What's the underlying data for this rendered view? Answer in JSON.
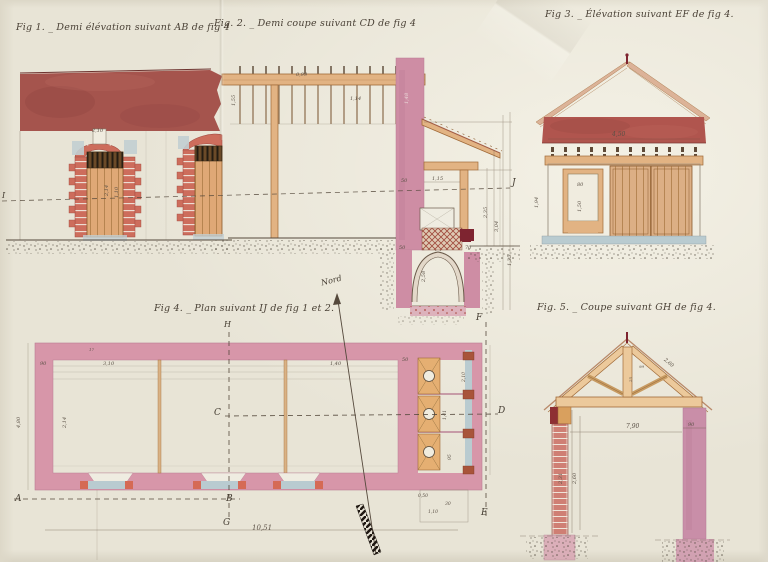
{
  "sheet": {
    "titles": {
      "fig1": "Fig 1. _ Demi élévation suivant AB de fig 4",
      "fig2": "Fig. 2. _ Demi coupe suivant CD de fig 4",
      "fig3": "Fig 3. _ Élévation suivant EF de fig 4.",
      "fig4": "Fig 4. _ Plan suivant IJ de fig 1 et 2.",
      "fig5": "Fig. 5. _ Coupe suivant GH de fig 4."
    },
    "north_label": "Nord",
    "letters": {
      "A": "A",
      "B": "B",
      "C": "C",
      "D": "D",
      "E": "E",
      "F": "F",
      "G": "G",
      "H": "H",
      "I": "I",
      "J": "J"
    },
    "dims": {
      "fig1": [
        "2,10",
        "2,14",
        "1,10"
      ],
      "fig2": [
        "0,99",
        "1,55",
        "1,14",
        "1,48",
        "50",
        "1,15",
        "2,35",
        "3,04",
        "1,35",
        "50",
        "70",
        "2,58"
      ],
      "fig3": [
        "4,50",
        "1,94",
        "80",
        "1,50"
      ],
      "fig4": [
        "3,10",
        "90",
        "1,40",
        "50",
        "4,80",
        "2,14",
        "2,10",
        "1,41",
        "95",
        "10,51",
        "0,50",
        "30",
        "1,10",
        "17"
      ],
      "fig5": [
        "7,90",
        "90",
        "2,31",
        "2,60",
        "2,60",
        "99",
        "25"
      ]
    },
    "colors": {
      "paper": "#e8e4d6",
      "roof_red": "#a5544d",
      "fascia_red": "#b0554e",
      "wall_pink": "#d796a9",
      "pier_pink": "#ce8da4",
      "wood_tan": "#e2b383",
      "truss_tan": "#ecc99b",
      "door_tan": "#dfa876",
      "brick_red": "#cd6d5c",
      "sill_blue": "#b9cbd0",
      "dark_red": "#7e2430",
      "ink": "#55493c"
    }
  }
}
